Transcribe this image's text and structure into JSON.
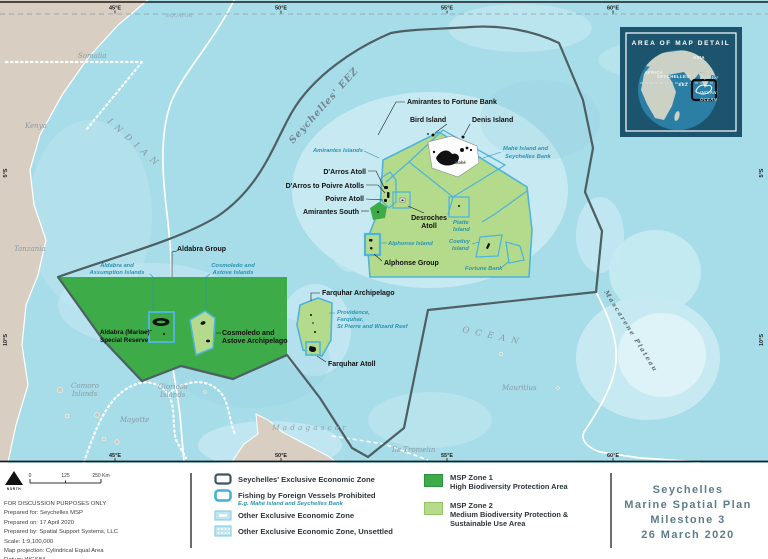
{
  "colors": {
    "ocean": "#a7dce9",
    "zone1_green": "#3dab48",
    "zone2_green": "#b4db8c",
    "zone_border_blue": "#4fb4d8",
    "eez_boundary": "#4d5f63",
    "teal_label": "#2a93b0",
    "title_text": "#5e7d8b",
    "land_tan": "#d8cec1",
    "inset_bg": "#1c546e"
  },
  "map": {
    "ticks_lon": [
      "45°E",
      "50°E",
      "55°E",
      "60°E"
    ],
    "ticks_lat": [
      "5°S",
      "10°S"
    ],
    "equator": "EQUATOR",
    "geo": {
      "somalia": "Somalia",
      "kenya": "Kenya",
      "tanzania": "Tanzania",
      "madagascar": "Madagascar",
      "comoro1": "Comoro",
      "comoro2": "Islands",
      "glorioso1": "Glorioso",
      "glorioso2": "Islands",
      "mayotte": "Mayotte",
      "mauritius": "Mauritius",
      "tromelin": "Ile Tromelin",
      "indian": "INDIAN",
      "ocean": "OCEAN",
      "mascarene": "Mascarene Plateau",
      "seychelles_eez": "Seychelles' EEZ"
    },
    "features": {
      "amirantes_fortune": "Amirantes to Fortune Bank",
      "bird": "Bird Island",
      "denis": "Denis Island",
      "darros": "D'Arros Atoll",
      "darros_poivre": "D'Arros to Poivre Atolls",
      "poivre": "Poivre Atoll",
      "amirantes_south": "Amirantes South",
      "desroches1": "Desroches",
      "desroches2": "Atoll",
      "alphonse_group": "Alphonse Group",
      "aldabra_group": "Aldabra Group",
      "cosmoledo1": "Cosmoledo and",
      "cosmoledo2": "Astove Archipelago",
      "reserve1": "Aldabra (Marine)",
      "reserve2": "Special Reserve",
      "farquhar_arch": "Farquhar Archipelago",
      "farquhar_atoll": "Farquhar Atoll",
      "mahe": "Mahé"
    },
    "islands": {
      "amirantes_is": "Amirantes Islands",
      "mahe_bank1": "Mahé Island and",
      "mahe_bank2": "Seychelles Bank",
      "alphonse_is": "Alphonse Island",
      "platte1": "Platte",
      "platte2": "Island",
      "coetivy1": "Coetivy",
      "coetivy2": "Island",
      "fortune": "Fortune Bank",
      "ald_ass1": "Aldabra and",
      "ald_ass2": "Assumption Islands",
      "cos_ast1": "Cosmoledo and",
      "cos_ast2": "Astove Islands",
      "prov1": "Providence,",
      "prov2": "Farquhar,",
      "prov3": "St Pierre and Wizard Reef"
    }
  },
  "inset": {
    "title": "AREA OF MAP DETAIL",
    "africa": "AFRICA",
    "asia": "ASIA",
    "seychelles": "SEYCHELLES'",
    "eez": "EEZ",
    "equator": "Equator",
    "indian": "INDIAN",
    "ocean": "OCEAN"
  },
  "credits": {
    "north": "NORTH",
    "scale0": "0",
    "scale125": "125",
    "scale250": "250 Km",
    "lines": [
      "FOR DISCUSSION PURPOSES ONLY",
      "Prepared for: Seychelles MSP",
      "Prepared on: 17 April 2020",
      "Prepared by: Spatial Support Systems, LLC",
      "Scale: 1:9,100,000",
      "Map projection: Cylindrical Equal Area",
      "Datum: WGS84",
      "Data Sources: Seychelles Government, MEECC Geodatabase,",
      "The Nature Conservancy, ESRI"
    ]
  },
  "legend": {
    "eez_label": "Seychelles' Exclusive Economic Zone",
    "fishing_label": "Fishing by Foreign Vessels Prohibited",
    "eg_label": "E.g. Mahé Island and Seychelles Bank",
    "other_eez_label": "Other Exclusive Economic Zone",
    "other_unsettled_label": "Other Exclusive Economic Zone, Unsettled",
    "zone1_name": "MSP Zone 1",
    "zone1_desc": "High Biodiversity Protection Area",
    "zone2_name": "MSP Zone 2",
    "zone2_desc1": "Medium Biodiversity Protection &",
    "zone2_desc2": "Sustainable Use Area"
  },
  "title_block": {
    "line1": "Seychelles",
    "line2": "Marine Spatial Plan",
    "line3": "Milestone 3",
    "line4": "26 March 2020"
  }
}
